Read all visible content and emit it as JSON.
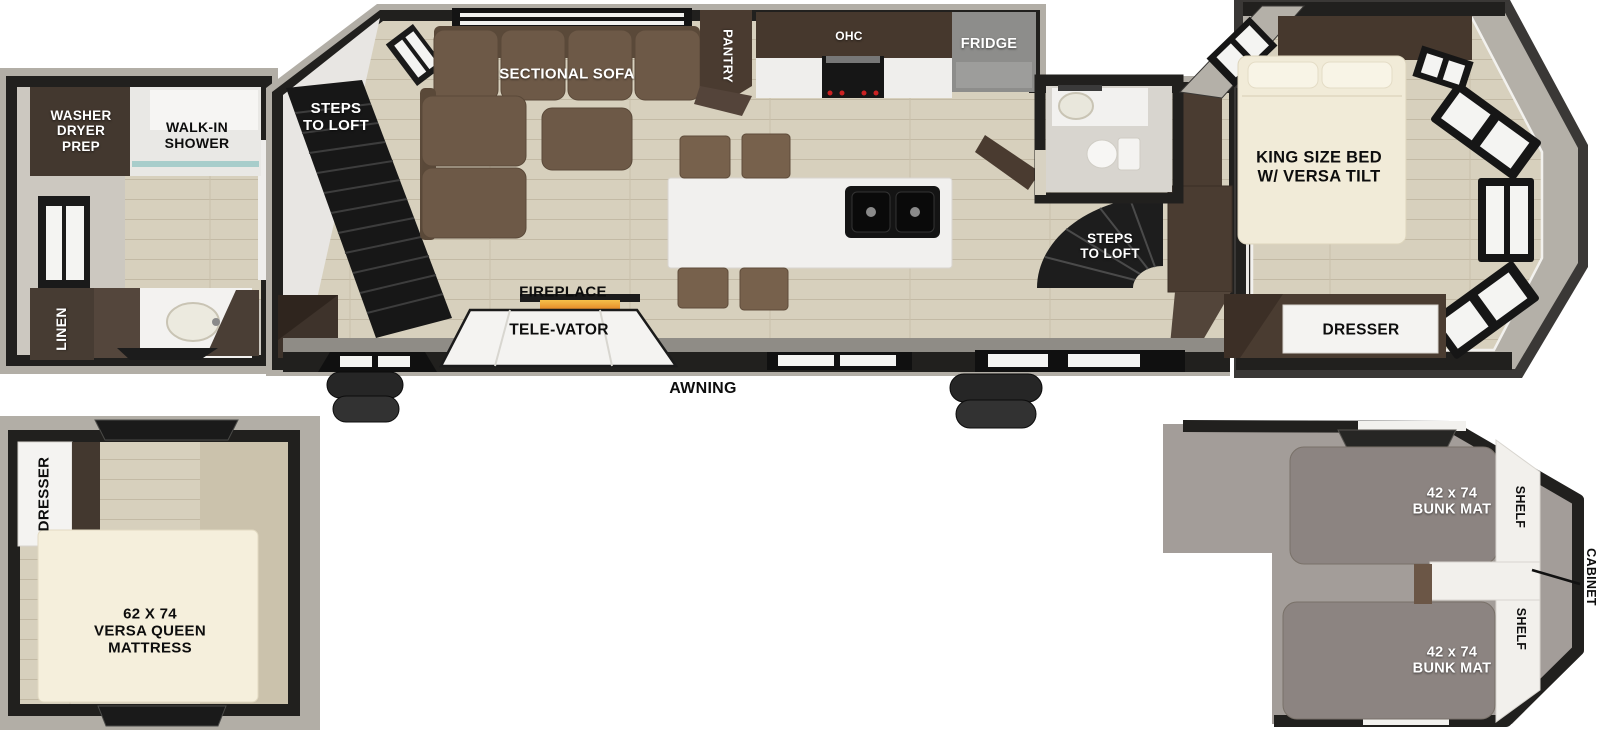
{
  "floorplan": {
    "rear_bath": {
      "washer_dryer_prep": "WASHER\nDRYER\nPREP",
      "walk_in_shower": "WALK-IN\nSHOWER",
      "linen": "LINEN"
    },
    "living_kitchen": {
      "steps_to_loft_rear": "STEPS\nTO LOFT",
      "sectional_sofa": "SECTIONAL SOFA",
      "pantry": "PANTRY",
      "ohc": "OHC",
      "fridge": "FRIDGE",
      "fireplace": "FIREPLACE",
      "tele_vator": "TELE-VATOR",
      "awning": "AWNING",
      "steps_to_loft_front": "STEPS\nTO LOFT"
    },
    "master_bedroom": {
      "king_bed": "KING SIZE BED\nW/ VERSA TILT",
      "dresser": "DRESSER"
    },
    "queen_loft": {
      "dresser": "DRESSER",
      "mattress": "62 X 74\nVERSA QUEEN\nMATTRESS"
    },
    "bunk_loft": {
      "bunk_mat_front": "42 x 74\nBUNK MAT",
      "bunk_mat_rear": "42 x 74\nBUNK MAT",
      "shelf_front": "SHELF",
      "shelf_rear": "SHELF",
      "cabinet": "CABINET"
    }
  },
  "colors": {
    "wall": "#21201e",
    "outer_trim": "#b2aea6",
    "floor_plank": "#d7d0bd",
    "sofa_brown": "#6d5947",
    "cabinet_brown": "#4a3c31",
    "counter_white": "#f1f0ee",
    "fridge_gray": "#8d8d8b",
    "loft_carpet": "#a39d99",
    "bunk_mat_gray": "#8c8481",
    "bed_cream": "#f1ebd8",
    "mattress_cream": "#f5efdc"
  }
}
